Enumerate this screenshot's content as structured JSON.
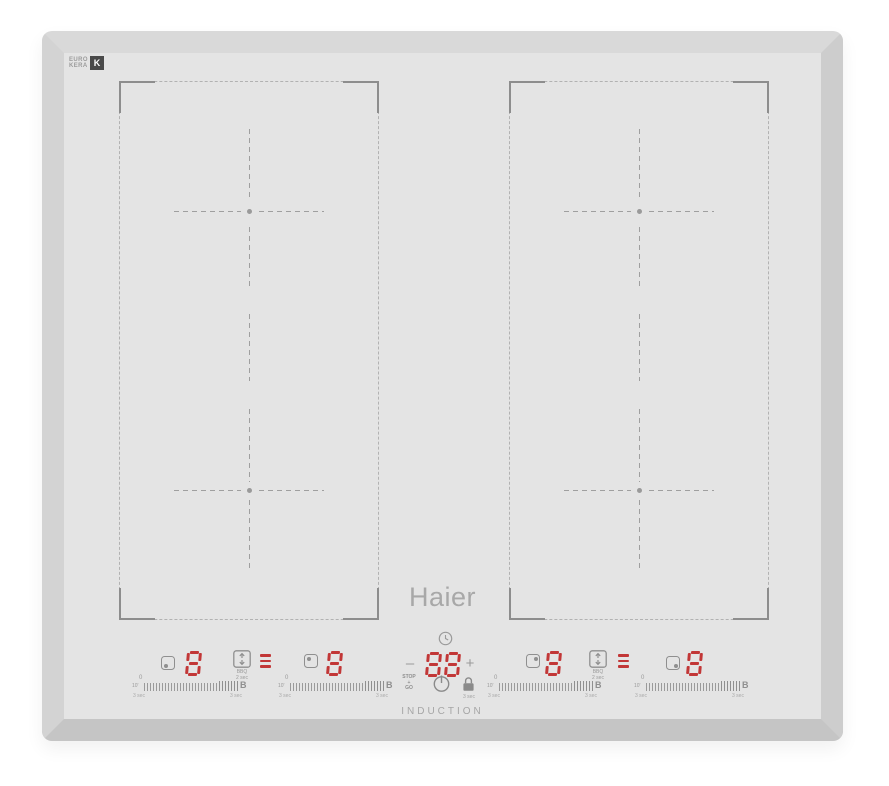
{
  "branding": {
    "logo_text": "Haier",
    "product_type": "INDUCTION",
    "glass_maker_line1": "EURO",
    "glass_maker_line2": "KERA",
    "glass_maker_mark": "K"
  },
  "colors": {
    "surface": "#e4e4e4",
    "bevel_bottom": "#c5c5c5",
    "display_red": "#c23737",
    "marking_gray": "#9f9f9f",
    "icon_gray": "#8f8f8f"
  },
  "burners": [
    {
      "name": "left-front",
      "power": "8",
      "indicator_corner": "bottom-left"
    },
    {
      "name": "left-rear",
      "power": "8",
      "indicator_corner": "top-left"
    },
    {
      "name": "right-rear",
      "power": "8",
      "indicator_corner": "top-right"
    },
    {
      "name": "right-front",
      "power": "8",
      "indicator_corner": "bottom-right"
    }
  ],
  "bridge": {
    "hint_line1": "BBQ",
    "hint_line2": "2 sec"
  },
  "timer": {
    "value": "88",
    "minus": "–",
    "plus": "+",
    "stop_go": [
      "STOP",
      "+",
      "GO"
    ],
    "lock_hold_hint": "3 sec"
  },
  "slider_labels": {
    "min": "0",
    "left_small": "10'",
    "hold_hint": "3 sec",
    "max": "B"
  }
}
